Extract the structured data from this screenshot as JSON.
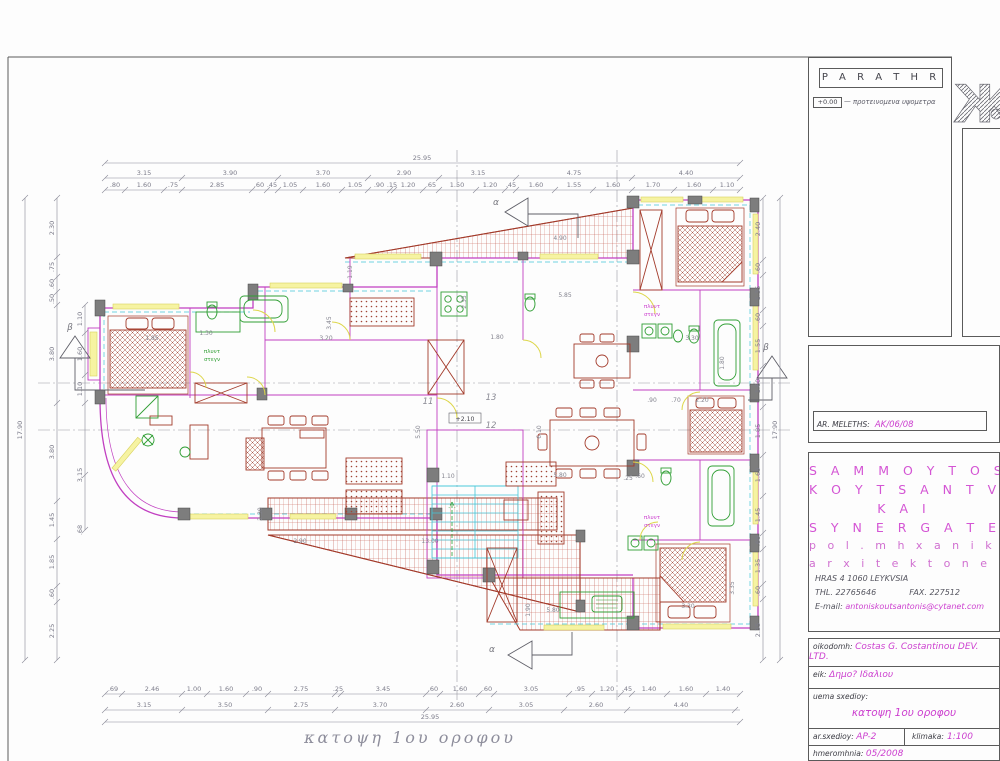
{
  "sheet": {
    "caption": "κατοψη 1ου οροφου",
    "notes": {
      "title": "P A R A T H R H S E I S",
      "symbol": "+0.00",
      "text": "— προτεινομενα υψομετρα"
    },
    "meleths": {
      "label": "AR. MELETHS:",
      "value": "AK/06/08"
    },
    "firm": {
      "name1": "S A M M O Y T O S",
      "name2": "K O Y T S A N T V N H",
      "name3": "K A I",
      "name4": "S Y N E R G A T E S",
      "prof1": "p o l .  m h x a n i k o i",
      "prof2": "a r x i t e k t o n e s",
      "address": "HRAS 4   1060 LEYKVSIA",
      "tel": "THL. 22765646",
      "fax": "FAX. 227512",
      "email_label": "E-mail:",
      "email": "antoniskoutsantonis@cytanet.com"
    },
    "table": {
      "r1l": "oikodomh:",
      "r1v": "Costas G. Costantinou DEV. LTD.",
      "r2l": "eik:",
      "r2v": "Δημο? Ιδαλιου",
      "r3l": "uema sxedioy:",
      "r3v": "κατοψη 1ου οροφου",
      "r4l": "ar.sxedioy:",
      "r4v": "AP-2",
      "r4l2": "klimaka:",
      "r4v2": "1:100",
      "r5l": "hmeromhnia:",
      "r5v": "05/2008"
    }
  },
  "plan": {
    "dims": {
      "top_overall": [
        "25.95"
      ],
      "top1": [
        "3.15",
        "3.90",
        "3.70",
        "2.90",
        "3.15",
        "4.75",
        "4.40"
      ],
      "top2": [
        ".80",
        "1.60",
        ".75",
        "2.85",
        ".60",
        ".45",
        "1.05",
        "1.60",
        "1.05",
        ".90",
        ".15",
        "1.20",
        ".65",
        "1.50",
        "1.20",
        ".45",
        "1.60",
        "1.55",
        "1.60",
        "1.70",
        "1.60",
        "1.10"
      ],
      "bottom1": [
        ".69",
        "2.46",
        "1.00",
        "1.60",
        ".90",
        "2.75",
        ".25",
        "3.45",
        ".60",
        "1.60",
        ".60",
        "3.05",
        ".95",
        "1.20",
        ".45",
        "1.40",
        "1.60",
        "1.40"
      ],
      "bottom2": [
        "3.15",
        "3.50",
        "2.75",
        "3.70",
        "2.60",
        "3.05",
        "2.60",
        "4.40"
      ],
      "bottom_overall": [
        "25.95"
      ],
      "left1": [
        "2.30",
        ".75",
        ".60",
        ".50",
        "3.80",
        "3.80",
        "1.45",
        "1.85",
        ".60",
        "2.25"
      ],
      "left2": [
        "1.10",
        "1.60",
        "1.10",
        "3.15",
        ".68"
      ],
      "left_overall": [
        "17.90"
      ],
      "right1": [
        "2.40",
        ".60",
        "1.35",
        ".60",
        "1.55",
        "1.60",
        "1.85",
        "1.60",
        "1.45",
        ".60",
        "1.35",
        ".60",
        "2.35"
      ],
      "right_overall": [
        "17.90"
      ]
    },
    "inline": [
      "1.85",
      "1.30",
      "3.20",
      "1.80",
      "5.85",
      "4.90",
      "1.19",
      "3.45",
      "2.35",
      "5.80",
      "1.10",
      "6.10",
      "5.50",
      "2.90",
      "13.00",
      "5.80",
      "1.90",
      "3.30",
      "2.20",
      ".90",
      ".70",
      "1.80",
      "3.35",
      "3.30",
      "2.30",
      ".25",
      ".60"
    ],
    "labels": {
      "r11": "11",
      "r12": "12",
      "r13": "13",
      "level": "+2.10",
      "alpha": "α",
      "beta": "β",
      "laundry1": "πλυντ",
      "laundry2": "στεγν"
    }
  }
}
